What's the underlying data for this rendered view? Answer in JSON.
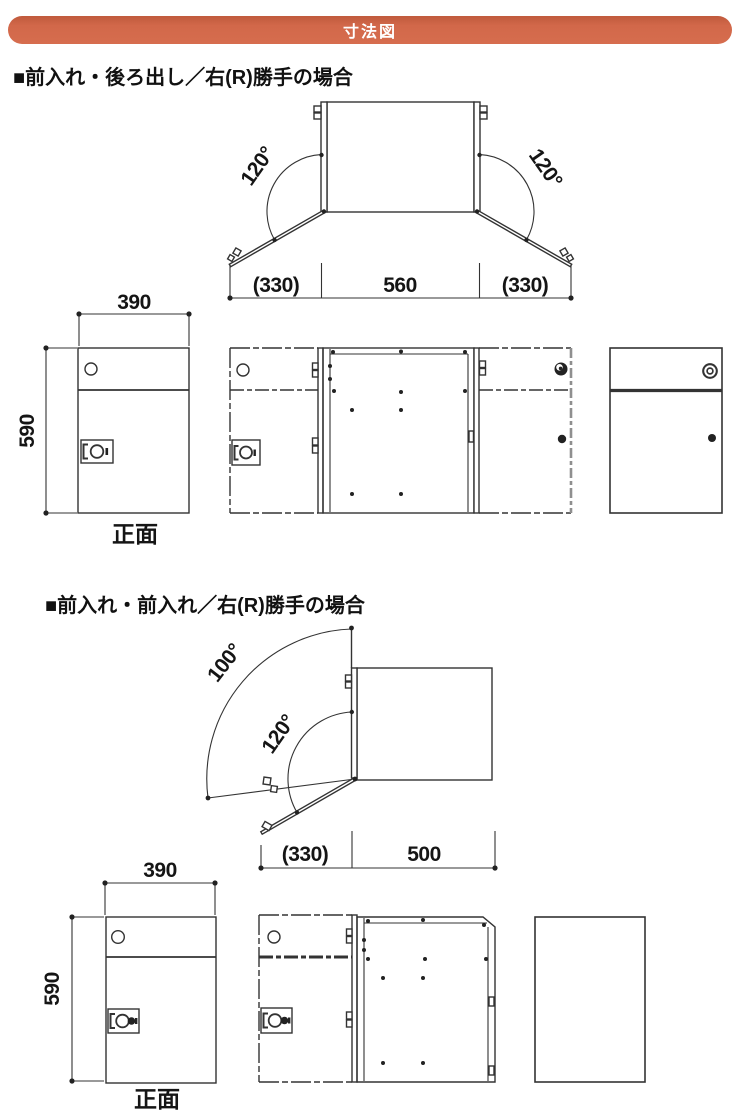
{
  "header": {
    "title": "寸法図"
  },
  "sections": [
    {
      "title": "■前入れ・後ろ出し／右(R)勝手の場合",
      "top_view": {
        "angle_left": "120°",
        "angle_right": "120°",
        "dim_left": "(330)",
        "dim_center": "560",
        "dim_right": "(330)"
      },
      "front_view": {
        "width": "390",
        "height": "590",
        "caption": "正面"
      }
    },
    {
      "title": "■前入れ・前入れ／右(R)勝手の場合",
      "top_view": {
        "angle_outer": "100°",
        "angle_inner": "120°",
        "dim_left": "(330)",
        "dim_right": "500"
      },
      "front_view": {
        "width": "390",
        "height": "590",
        "caption": "正面"
      }
    }
  ],
  "colors": {
    "banner": "#d2684a",
    "banner_text": "#ffffff",
    "line": "#333333",
    "gray_edge": "#8f8f8f"
  }
}
